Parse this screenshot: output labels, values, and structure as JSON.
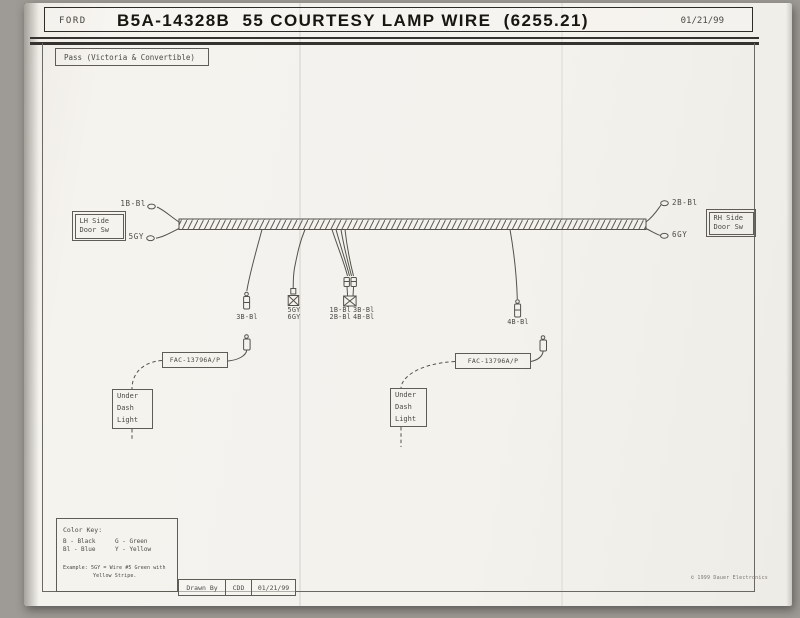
{
  "header": {
    "brand": "FORD",
    "title": "B5A-14328B  55 COURTESY LAMP WIRE  (6255.21)",
    "date": "01/21/99"
  },
  "variant_label": "Pass (Victoria & Convertible)",
  "lh_switch": {
    "line1": "LH Side",
    "line2": "Door Sw"
  },
  "rh_switch": {
    "line1": "RH Side",
    "line2": "Door Sw"
  },
  "wire_labels": {
    "lh_top": "1B-Bl",
    "lh_bottom": "5GY",
    "rh_top": "2B-Bl",
    "rh_bottom": "6GY",
    "drop_a": "3B-Bl",
    "drop_b_top": "5GY",
    "drop_b_bottom": "6GY",
    "drop_c_r1a": "1B-Bl",
    "drop_c_r1b": "3B-Bl",
    "drop_c_r2a": "2B-Bl",
    "drop_c_r2b": "4B-Bl",
    "drop_d": "4B-Bl"
  },
  "connectors": {
    "left_part": "FAC-13796A/P",
    "right_part": "FAC-13796A/P"
  },
  "lamps": {
    "left": {
      "line1": "Under",
      "line2": "Dash",
      "line3": "Light"
    },
    "right": {
      "line1": "Under",
      "line2": "Dash",
      "line3": "Light"
    }
  },
  "color_key": {
    "heading": "Color Key:",
    "row1_col1": "B - Black",
    "row2_col1": "Bl - Blue",
    "row1_col2": "G - Green",
    "row2_col2": "Y - Yellow",
    "example1": "Example: 5GY = Wire #5 Green with",
    "example2": "Yellow Stripe."
  },
  "title_block": {
    "drawn_by": "Drawn By",
    "initials": "CDD",
    "date": "01/21/99"
  },
  "copyright": "© 1999 Dauer Electronics",
  "colors": {
    "ink": "#54524b",
    "paper": "#f4f2ed"
  }
}
